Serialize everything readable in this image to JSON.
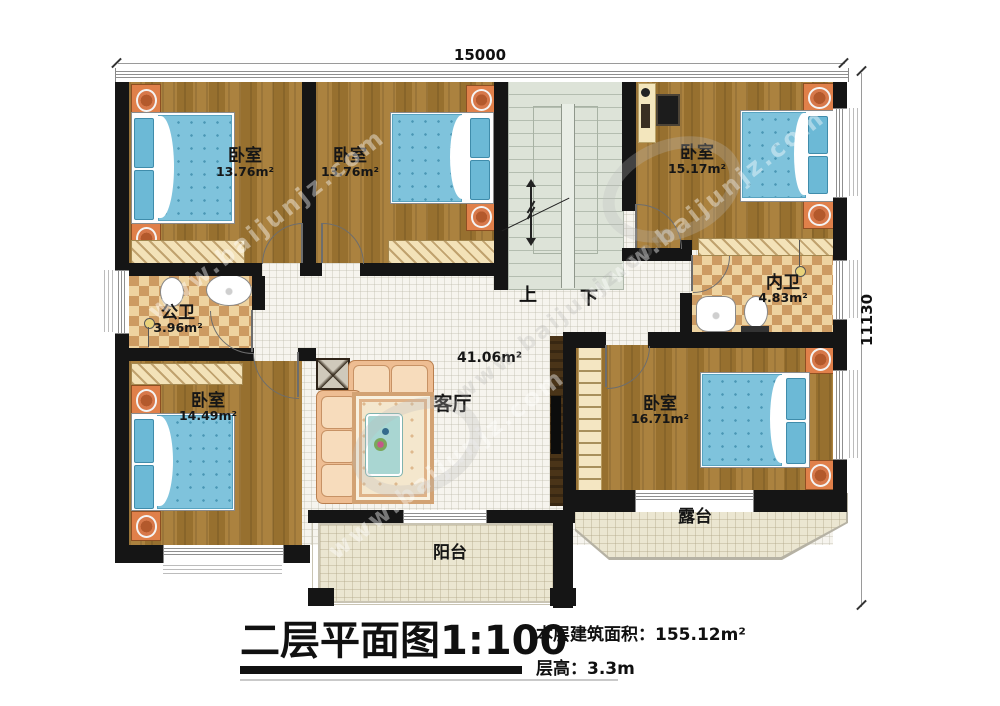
{
  "title_block": {
    "title": "二层平面图1:100",
    "building_area_label": "本层建筑面积：",
    "building_area_value": "155.12m²",
    "floor_height_label": "层高：",
    "floor_height_value": "3.3m"
  },
  "dimensions": {
    "width_mm": "15000",
    "height_mm": "11130"
  },
  "stairs": {
    "up_label": "上",
    "down_label": "下"
  },
  "watermark": {
    "text": "www.baijunjz.com"
  },
  "rooms": {
    "bedroom_tl": {
      "name": "卧室",
      "area": "13.76m²"
    },
    "bedroom_tm": {
      "name": "卧室",
      "area": "13.76m²"
    },
    "bedroom_tr": {
      "name": "卧室",
      "area": "15.17m²"
    },
    "public_bath": {
      "name": "公卫",
      "area": "3.96m²"
    },
    "inner_bath": {
      "name": "内卫",
      "area": "4.83m²"
    },
    "bedroom_bl": {
      "name": "卧室",
      "area": "14.49m²"
    },
    "living_room": {
      "name": "客厅",
      "area": "41.06m²"
    },
    "bedroom_br": {
      "name": "卧室",
      "area": "16.71m²"
    },
    "balcony": {
      "name": "阳台"
    },
    "terrace": {
      "name": "露台"
    }
  },
  "colors": {
    "wall": "#151515",
    "wood_floor": "#a67c3c",
    "tile_light": "#f6f4ee",
    "bath_checker_dark": "#cd9b62",
    "bath_checker_light": "#eed3a0",
    "stairs_floor": "#dde3d8",
    "bed_mattress": "#7fc3dc",
    "nightstand": "#e0804a",
    "balcony_floor": "#ebe6d1"
  }
}
